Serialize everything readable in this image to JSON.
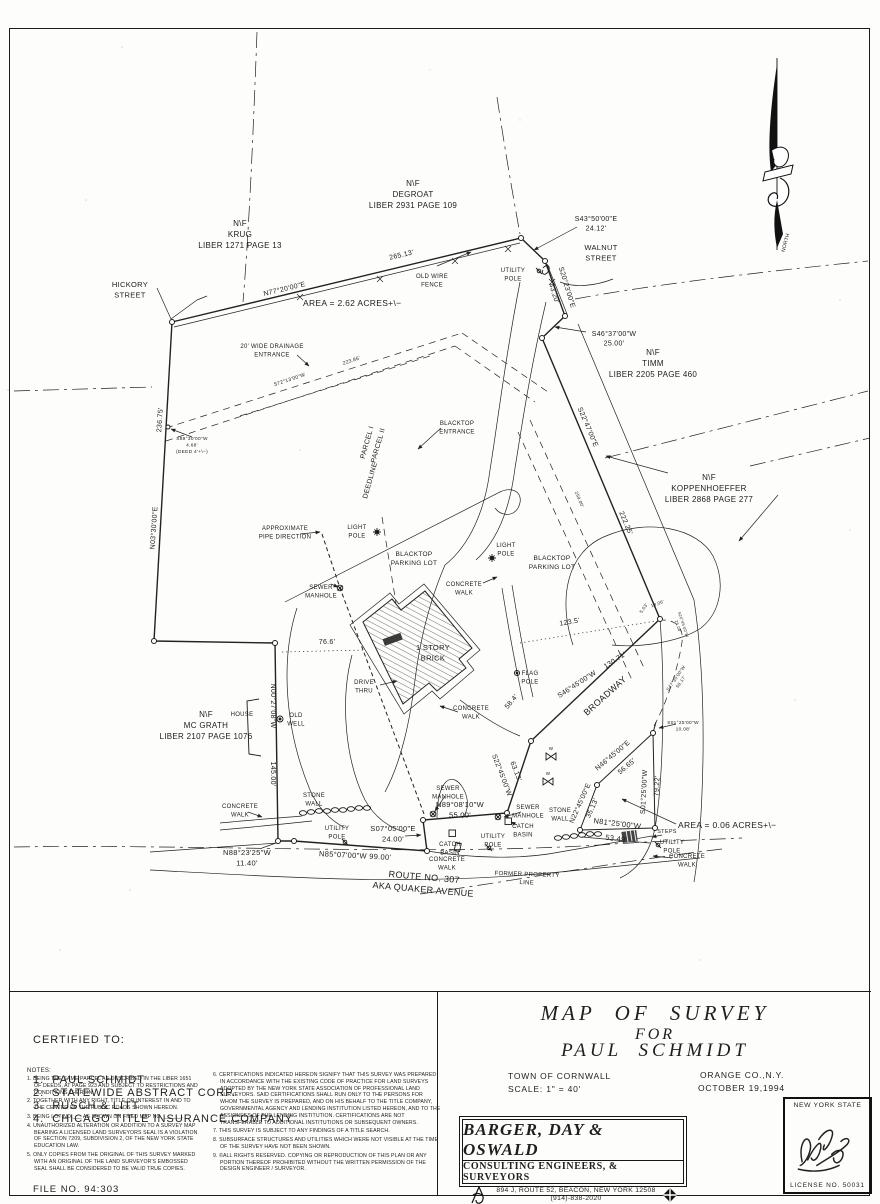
{
  "colors": {
    "ink": "#1f1f1f",
    "paper": "#fdfdfb"
  },
  "document": {
    "certified": {
      "heading": "CERTIFIED TO:",
      "items": [
        "1.  PAUL SCHMIDT",
        "2.  STATEWIDE ABSTRACT CORP.",
        "3.  RUSCH & LITT",
        "4.  CHICAGO TITLE INSURANCE COMPANY"
      ]
    },
    "notes_heading": "NOTES:",
    "notes_col1": [
      "1. BEING THE SAME PARCEL AS DESCRIBED IN THE LIBER 1651 OF DEEDS, AT PAGE 923 AND SUBJECT TO RESTRICTIONS AND CONDITIONS THEREIN.",
      "2. TOGETHER WITH ANY RIGHT, TITLE OR INTEREST IN AND TO THE CENTER OF THE PUBLIC ROADS SHOWN HEREON.",
      "3. BEING LOT NO.___ AS SHOWN ON FILED MAP NO. ______.",
      "4. UNAUTHORIZED ALTERATION OR ADDITION TO A SURVEY MAP BEARING A LICENSED LAND SURVEYORS SEAL IS A VIOLATION OF SECTION 7209, SUBDIVISION 2, OF THE NEW YORK STATE EDUCATION LAW.",
      "5. ONLY COPIES FROM THE ORIGINAL OF THIS SURVEY MARKED WITH AN ORIGINAL OF THE LAND SURVEYOR'S EMBOSSED SEAL SHALL BE CONSIDERED TO BE VALID TRUE COPIES."
    ],
    "notes_col2": [
      "6. CERTIFICATIONS INDICATED HEREON SIGNIFY THAT THIS SURVEY WAS PREPARED IN ACCORDANCE WITH THE EXISTING CODE OF PRACTICE FOR LAND SURVEYS ADOPTED BY THE NEW YORK STATE ASSOCIATION OF PROFESSIONAL LAND SURVEYORS. SAID CERTIFICATIONS SHALL RUN ONLY TO THE PERSONS FOR WHOM THE SURVEY IS PREPARED, AND ON HIS BEHALF TO THE TITLE COMPANY, GOVERNMENTAL AGENCY AND LENDING INSTITUTION LISTED HEREON, AND TO THE ASSIGNEES OF THE LENDING INSTITUTION. CERTIFICATIONS ARE NOT TRANSFERABLE TO ADDITIONAL INSTITUTIONS OR SUBSEQUENT OWNERS.",
      "7. THIS SURVEY IS SUBJECT TO ANY FINDINGS OF A TITLE SEARCH.",
      "8. SUBSURFACE STRUCTURES AND UTILITIES WHICH WERE NOT VISIBLE AT THE TIME OF THE SURVEY HAVE NOT BEEN SHOWN.",
      "9. ©ALL RIGHTS RESERVED. COPYING OR REPRODUCTION OF THIS PLAN OR ANY PORTION THEREOF PROHIBITED WITHOUT THE WRITTEN PERMISSION OF THE DESIGN ENGINEER / SURVEYOR."
    ],
    "file_no": "FILE NO.  94:303",
    "title_block": {
      "line1": "MAP  OF  SURVEY",
      "line2": "FOR",
      "line3": "PAUL  SCHMIDT",
      "town": "TOWN OF CORNWALL",
      "scale": "SCALE: 1\" = 40'",
      "county": "ORANGE CO.,N.Y.",
      "date": "OCTOBER 19,1994"
    },
    "firm": {
      "name": "BARGER,  DAY  &  OSWALD",
      "tagline": "CONSULTING  ENGINEERS,  &  SURVEYORS",
      "address": "894 J, ROUTE 52, BEACON, NEW YORK 12508",
      "phone": "(914)-838-2020"
    },
    "license": {
      "state": "NEW YORK STATE",
      "number": "LICENSE  NO.  50031"
    }
  },
  "map": {
    "labels": [
      {
        "id": "nf-degroat",
        "lines": [
          "N\\F",
          "DEGROAT",
          "LIBER 2931 PAGE 109"
        ],
        "x": 413,
        "y": 186,
        "size": 8
      },
      {
        "id": "nf-krug",
        "lines": [
          "N\\F",
          "KRUG",
          "LIBER 1271 PAGE 13"
        ],
        "x": 240,
        "y": 226,
        "size": 8
      },
      {
        "id": "hickory-street",
        "lines": [
          "HICKORY",
          "STREET"
        ],
        "x": 130,
        "y": 287,
        "size": 7.5
      },
      {
        "id": "walnut-street",
        "lines": [
          "WALNUT",
          "STREET"
        ],
        "x": 601,
        "y": 250,
        "size": 7.5
      },
      {
        "id": "bearing-s4350",
        "lines": [
          "S43°50'00\"E",
          "24.12'"
        ],
        "x": 596,
        "y": 221,
        "size": 7
      },
      {
        "id": "dim-26513",
        "text": "265.13'",
        "x": 402,
        "y": 257,
        "rot": -13.5,
        "size": 7
      },
      {
        "id": "bearing-n7720",
        "text": "N77°20'00\"E",
        "x": 285,
        "y": 291,
        "rot": -13.5,
        "size": 7
      },
      {
        "id": "old-wire-fence",
        "lines": [
          "OLD WIRE",
          "FENCE"
        ],
        "x": 432,
        "y": 278,
        "size": 6
      },
      {
        "id": "utility-pole-walnut",
        "lines": [
          "UTILITY",
          "POLE"
        ],
        "x": 513,
        "y": 272,
        "size": 6
      },
      {
        "id": "area-parcel-1",
        "text": "AREA = 2.62 ACRES+\\−",
        "x": 303,
        "y": 306,
        "size": 8.5,
        "anchor": "start"
      },
      {
        "id": "bearing-s2023",
        "text": "S20°23'00\"E",
        "x": 565,
        "y": 288,
        "rot": 73,
        "size": 7
      },
      {
        "id": "dim-4320",
        "text": "43.20'",
        "x": 552,
        "y": 294,
        "rot": 73,
        "size": 7
      },
      {
        "id": "bearing-s4637",
        "lines": [
          "S46°37'00\"W",
          "25.00'"
        ],
        "x": 614,
        "y": 336,
        "size": 7
      },
      {
        "id": "nf-timm",
        "lines": [
          "N\\F",
          "TIMM",
          "LIBER 2205 PAGE 460"
        ],
        "x": 653,
        "y": 355,
        "size": 8
      },
      {
        "id": "drainage-note",
        "lines": [
          "20' WIDE DRAINAGE",
          "ENTRANCE"
        ],
        "x": 272,
        "y": 348,
        "size": 6
      },
      {
        "id": "bearing-s7213",
        "text": "S72°13'00\"W",
        "x": 290,
        "y": 381,
        "rot": -18,
        "size": 5
      },
      {
        "id": "dim-22386",
        "text": "223.86'",
        "x": 352,
        "y": 362,
        "rot": -18,
        "size": 5
      },
      {
        "id": "deed-note",
        "lines": [
          "S89°30'00\"W",
          "4.68'",
          "(DEED 4'+\\−)"
        ],
        "x": 192,
        "y": 440,
        "size": 4.8
      },
      {
        "id": "dim-23675",
        "text": "236.75'",
        "x": 162,
        "y": 420,
        "rot": -86,
        "size": 7
      },
      {
        "id": "bearing-n0330",
        "text": "N03°30'00\"E",
        "x": 156,
        "y": 528,
        "rot": -86,
        "size": 7
      },
      {
        "id": "blacktop-entrance",
        "lines": [
          "BLACKTOP",
          "ENTRANCE"
        ],
        "x": 457,
        "y": 425,
        "size": 6
      },
      {
        "id": "bearing-s2247",
        "text": "S22°47'00\"E",
        "x": 586,
        "y": 428,
        "rot": 67,
        "size": 7
      },
      {
        "id": "dim-22225",
        "text": "222.25'",
        "x": 624,
        "y": 524,
        "rot": 67,
        "size": 7
      },
      {
        "id": "nf-koppenhoeffer",
        "lines": [
          "N\\F",
          "KOPPENHOEFFER",
          "LIBER 2868 PAGE 277"
        ],
        "x": 709,
        "y": 480,
        "size": 8
      },
      {
        "id": "dim-25900",
        "text": "259.00'",
        "x": 578,
        "y": 500,
        "rot": 67,
        "size": 4.5
      },
      {
        "id": "deedline-word",
        "text": "DEEDLINE",
        "x": 372,
        "y": 481,
        "rot": -74,
        "size": 7
      },
      {
        "id": "deedline-parcel-1",
        "text": "PARCEL I",
        "x": 369,
        "y": 443,
        "rot": -74,
        "size": 7
      },
      {
        "id": "deedline-parcel-2",
        "text": "PARCEL II",
        "x": 380,
        "y": 446,
        "rot": -74,
        "size": 7
      },
      {
        "id": "approx-pipe",
        "lines": [
          "APPROXIMATE",
          "PIPE DIRECTION"
        ],
        "x": 285,
        "y": 530,
        "size": 6
      },
      {
        "id": "light-pole-1",
        "lines": [
          "LIGHT",
          "POLE"
        ],
        "x": 357,
        "y": 529,
        "size": 6
      },
      {
        "id": "blacktop-parking-1",
        "lines": [
          "BLACKTOP",
          "PARKING LOT"
        ],
        "x": 414,
        "y": 556,
        "size": 6.5
      },
      {
        "id": "light-pole-2",
        "lines": [
          "LIGHT",
          "POLE"
        ],
        "x": 506,
        "y": 547,
        "size": 6
      },
      {
        "id": "blacktop-parking-2",
        "lines": [
          "BLACKTOP",
          "PARKING LOT"
        ],
        "x": 552,
        "y": 560,
        "size": 6.5
      },
      {
        "id": "sewer-manhole-1",
        "lines": [
          "SEWER",
          "MANHOLE"
        ],
        "x": 321,
        "y": 589,
        "size": 6
      },
      {
        "id": "concrete-walk-1",
        "lines": [
          "CONCRETE",
          "WALK"
        ],
        "x": 464,
        "y": 586,
        "size": 6
      },
      {
        "id": "building-label",
        "lines": [
          "1 STORY",
          "BRICK"
        ],
        "x": 433,
        "y": 650,
        "size": 7.5
      },
      {
        "id": "dim-766",
        "text": "76.6'",
        "x": 327,
        "y": 644,
        "size": 7
      },
      {
        "id": "drive-thru",
        "lines": [
          "DRIVE",
          "THRU"
        ],
        "x": 364,
        "y": 684,
        "size": 6
      },
      {
        "id": "flag-pole",
        "lines": [
          "FLAG",
          "POLE"
        ],
        "x": 530,
        "y": 675,
        "size": 6
      },
      {
        "id": "dim-584",
        "text": "58.4'",
        "x": 513,
        "y": 703,
        "rot": -50,
        "size": 7
      },
      {
        "id": "concrete-walk-2",
        "lines": [
          "CONCRETE",
          "WALK"
        ],
        "x": 471,
        "y": 710,
        "size": 6
      },
      {
        "id": "old-well",
        "lines": [
          "OLD",
          "WELL"
        ],
        "x": 296,
        "y": 717,
        "size": 6
      },
      {
        "id": "house",
        "text": "HOUSE",
        "x": 242,
        "y": 716,
        "size": 6
      },
      {
        "id": "nf-mcgrath",
        "lines": [
          "N\\F",
          "MC GRATH",
          "LIBER 2107 PAGE 1076"
        ],
        "x": 206,
        "y": 717,
        "size": 8
      },
      {
        "id": "bearing-n002708",
        "text": "N00°27'08\"W",
        "x": 271,
        "y": 706,
        "rot": 90,
        "size": 7
      },
      {
        "id": "dim-14500",
        "text": "145.00'",
        "x": 271,
        "y": 774,
        "rot": 90,
        "size": 7
      },
      {
        "id": "concrete-walk-3",
        "lines": [
          "CONCRETE",
          "WALK"
        ],
        "x": 240,
        "y": 808,
        "size": 6
      },
      {
        "id": "stone-wall-1",
        "lines": [
          "STONE",
          "WALL"
        ],
        "x": 314,
        "y": 797,
        "size": 6
      },
      {
        "id": "utility-pole-route",
        "lines": [
          "UTILITY",
          "POLE"
        ],
        "x": 337,
        "y": 830,
        "size": 6
      },
      {
        "id": "bearing-s0705",
        "lines": [
          "S07°05'00\"E",
          "24.00'"
        ],
        "x": 393,
        "y": 831,
        "size": 7.5
      },
      {
        "id": "bearing-n882325",
        "lines": [
          "N88°23'25\"W",
          "11.40'"
        ],
        "x": 247,
        "y": 855,
        "size": 7.5
      },
      {
        "id": "bearing-n8507",
        "text": "N85°07'00\"W  99.00'",
        "x": 355,
        "y": 858,
        "rot": 3,
        "size": 7.5
      },
      {
        "id": "route-307",
        "lines": [
          "ROUTE NO. 307",
          "AKA QUAKER AVENUE"
        ],
        "x": 424,
        "y": 880,
        "rot": 5,
        "size": 9,
        "ls": 1
      },
      {
        "id": "sewer-manhole-2",
        "lines": [
          "SEWER",
          "MANHOLE"
        ],
        "x": 448,
        "y": 790,
        "size": 6
      },
      {
        "id": "bearing-n890810",
        "lines": [
          "N89°08'10\"W",
          "55.00'"
        ],
        "x": 460,
        "y": 807,
        "size": 7.5
      },
      {
        "id": "bearing-s2245w",
        "text": "S22°45'00\"W",
        "x": 500,
        "y": 776,
        "rot": 69,
        "size": 7
      },
      {
        "id": "dim-6313",
        "text": "63.13'",
        "x": 514,
        "y": 772,
        "rot": 69,
        "size": 7
      },
      {
        "id": "sewer-manhole-3",
        "lines": [
          "SEWER",
          "MANHOLE"
        ],
        "x": 528,
        "y": 809,
        "size": 6
      },
      {
        "id": "catch-basin-1",
        "lines": [
          "CATCH",
          "BASIN"
        ],
        "x": 523,
        "y": 828,
        "size": 6
      },
      {
        "id": "utility-pole-mid",
        "lines": [
          "UTILITY",
          "POLE"
        ],
        "x": 493,
        "y": 838,
        "size": 6
      },
      {
        "id": "catch-basin-2",
        "lines": [
          "CATCH",
          "BASIN"
        ],
        "x": 450,
        "y": 846,
        "size": 6
      },
      {
        "id": "concrete-walk-4",
        "lines": [
          "CONCRETE",
          "WALK"
        ],
        "x": 447,
        "y": 861,
        "size": 6
      },
      {
        "id": "former-property-line",
        "lines": [
          "FORMER PROPERTY",
          "LINE"
        ],
        "x": 527,
        "y": 876,
        "rot": 2,
        "size": 6
      },
      {
        "id": "stone-wall-2",
        "lines": [
          "STONE",
          "WALL"
        ],
        "x": 560,
        "y": 812,
        "size": 6
      },
      {
        "id": "water-valve-1",
        "text": "W",
        "x": 551,
        "y": 750,
        "size": 4.5
      },
      {
        "id": "water-valve-2",
        "text": "W",
        "x": 548,
        "y": 775,
        "size": 4.5
      },
      {
        "id": "bearing-n2245",
        "text": "N22°45'00\"E",
        "x": 582,
        "y": 804,
        "rot": -66,
        "size": 7
      },
      {
        "id": "dim-3513",
        "text": "35.13'",
        "x": 594,
        "y": 809,
        "rot": -66,
        "size": 7
      },
      {
        "id": "bearing-n4645",
        "text": "N46°45'00\"E",
        "x": 614,
        "y": 757,
        "rot": -40,
        "size": 7
      },
      {
        "id": "dim-5665",
        "text": "56.65'",
        "x": 628,
        "y": 768,
        "rot": -40,
        "size": 7
      },
      {
        "id": "bearing-s0125",
        "text": "S01°25'00\"W",
        "x": 646,
        "y": 792,
        "rot": -87,
        "size": 7
      },
      {
        "id": "dim-7922",
        "text": "79.22'",
        "x": 659,
        "y": 786,
        "rot": -87,
        "size": 7
      },
      {
        "id": "bearing-s0125-small",
        "lines": [
          "S01°25'00\"W",
          "10.08'"
        ],
        "x": 683,
        "y": 724,
        "size": 4.8
      },
      {
        "id": "area-parcel-2",
        "text": "AREA = 0.06 ACRES+\\−",
        "x": 678,
        "y": 828,
        "size": 8.5,
        "anchor": "start"
      },
      {
        "id": "steps",
        "text": "STEPS",
        "x": 667,
        "y": 833,
        "size": 5.5
      },
      {
        "id": "bearing-n8125",
        "text": "N81°25'00\"W",
        "x": 617,
        "y": 826,
        "rot": 7,
        "size": 7.5
      },
      {
        "id": "dim-5349",
        "text": "53.49'",
        "x": 616,
        "y": 841,
        "rot": 7,
        "size": 7.5
      },
      {
        "id": "utility-pole-steps",
        "lines": [
          "UTILITY",
          "POLE"
        ],
        "x": 672,
        "y": 844,
        "size": 6
      },
      {
        "id": "concrete-walk-5",
        "lines": [
          "CONCRETE",
          "WALK"
        ],
        "x": 687,
        "y": 858,
        "size": 6
      },
      {
        "id": "bearing-s4645",
        "text": "S46°45'00\"W",
        "x": 578,
        "y": 686,
        "rot": -33,
        "size": 7
      },
      {
        "id": "dim-13071",
        "text": "130.71'",
        "x": 616,
        "y": 662,
        "rot": -33,
        "size": 7
      },
      {
        "id": "broadway",
        "text": "BROADWAY",
        "x": 607,
        "y": 698,
        "rot": -42,
        "size": 9,
        "ls": 1
      },
      {
        "id": "dim-1235",
        "text": "123.5'",
        "x": 570,
        "y": 624,
        "rot": -10,
        "size": 7
      },
      {
        "id": "dim-1806",
        "text": "18.06'",
        "x": 658,
        "y": 605,
        "rot": -20,
        "size": 4.5
      },
      {
        "id": "dim-503",
        "text": "5.03'",
        "x": 645,
        "y": 609,
        "rot": -55,
        "size": 4.5
      },
      {
        "id": "bearing-s2045-small",
        "lines": [
          "S20°45'00\"W",
          "25.08'"
        ],
        "x": 682,
        "y": 625,
        "rot": 72,
        "size": 4
      },
      {
        "id": "bearing-s4735-small",
        "lines": [
          "S47°35'00\"W",
          "58.17'"
        ],
        "x": 677,
        "y": 679,
        "rot": -55,
        "size": 4.5
      },
      {
        "id": "north-label",
        "text": "NORTH",
        "x": 787,
        "y": 243,
        "rot": -75,
        "size": 5
      }
    ]
  }
}
